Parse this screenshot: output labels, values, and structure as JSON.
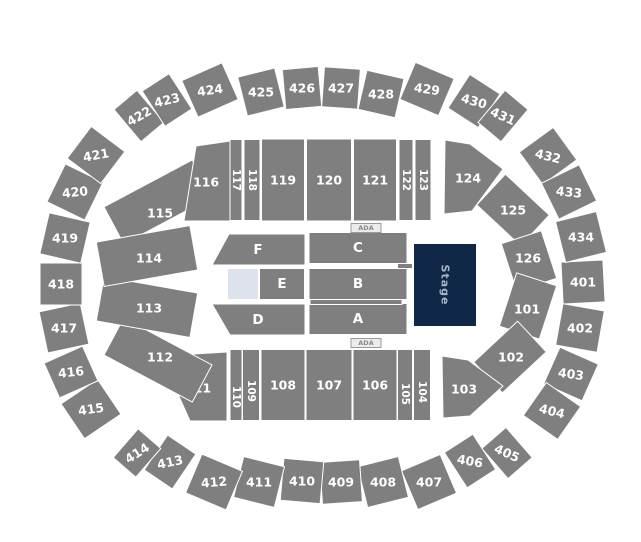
{
  "colors": {
    "section": "#7f7f7f",
    "sectionStroke": "#ffffff",
    "label": "#ffffff",
    "stage": "#0f2848",
    "stage_text": "#a9b4c6",
    "open": "#dce3ec",
    "ada_bg": "#ececec",
    "ada_border": "#9a9a9a",
    "ada_text": "#8a8a8a",
    "background": "#ffffff"
  },
  "map": {
    "width": 641,
    "height": 542,
    "sections": [
      {
        "label": "401",
        "cx": 583,
        "cy": 282,
        "w": 42,
        "h": 42,
        "rot": 87
      },
      {
        "label": "402",
        "cx": 580,
        "cy": 328,
        "w": 42,
        "h": 42,
        "rot": -80
      },
      {
        "label": "403",
        "cx": 571,
        "cy": 374,
        "w": 40,
        "h": 42,
        "rot": -66,
        "lrot": 8
      },
      {
        "label": "404",
        "cx": 552,
        "cy": 411,
        "w": 40,
        "h": 42,
        "rot": -55,
        "lrot": 14
      },
      {
        "label": "405",
        "cx": 507,
        "cy": 453,
        "w": 32,
        "h": 40,
        "rot": -41,
        "lrot": 24
      },
      {
        "label": "406",
        "cx": 470,
        "cy": 461,
        "w": 34,
        "h": 42,
        "rot": -33,
        "lrot": 10
      },
      {
        "label": "407",
        "cx": 429,
        "cy": 482,
        "w": 42,
        "h": 42,
        "rot": -23
      },
      {
        "label": "408",
        "cx": 383,
        "cy": 482,
        "w": 42,
        "h": 42,
        "rot": -14
      },
      {
        "label": "409",
        "cx": 341,
        "cy": 482,
        "w": 40,
        "h": 42,
        "rot": -4
      },
      {
        "label": "410",
        "cx": 302,
        "cy": 481,
        "w": 40,
        "h": 42,
        "rot": 5
      },
      {
        "label": "411",
        "cx": 259,
        "cy": 482,
        "w": 42,
        "h": 42,
        "rot": 14
      },
      {
        "label": "412",
        "cx": 214,
        "cy": 482,
        "w": 44,
        "h": 42,
        "rot": 23,
        "lrot": -5
      },
      {
        "label": "413",
        "cx": 170,
        "cy": 462,
        "w": 34,
        "h": 42,
        "rot": 34,
        "lrot": -12
      },
      {
        "label": "414",
        "cx": 137,
        "cy": 453,
        "w": 30,
        "h": 38,
        "rot": 41,
        "lrot": -33
      },
      {
        "label": "415",
        "cx": 91,
        "cy": 409,
        "w": 42,
        "h": 44,
        "rot": 56,
        "lrot": -8
      },
      {
        "label": "416",
        "cx": 71,
        "cy": 372,
        "w": 38,
        "h": 42,
        "rot": 66,
        "lrot": -6
      },
      {
        "label": "417",
        "cx": 64,
        "cy": 328,
        "w": 42,
        "h": 42,
        "rot": 78
      },
      {
        "label": "418",
        "cx": 61,
        "cy": 284,
        "w": 42,
        "h": 42,
        "rot": 90
      },
      {
        "label": "419",
        "cx": 65,
        "cy": 238,
        "w": 42,
        "h": 42,
        "rot": -77
      },
      {
        "label": "420",
        "cx": 75,
        "cy": 192,
        "w": 42,
        "h": 42,
        "rot": -64,
        "lrot": -6
      },
      {
        "label": "421",
        "cx": 96,
        "cy": 155,
        "w": 40,
        "h": 42,
        "rot": -53,
        "lrot": -10
      },
      {
        "label": "422",
        "cx": 139,
        "cy": 116,
        "w": 30,
        "h": 42,
        "rot": -40,
        "lrot": -30
      },
      {
        "label": "423",
        "cx": 167,
        "cy": 100,
        "w": 32,
        "h": 42,
        "rot": -33,
        "lrot": -14
      },
      {
        "label": "424",
        "cx": 210,
        "cy": 90,
        "w": 44,
        "h": 40,
        "rot": -24,
        "lrot": -8
      },
      {
        "label": "425",
        "cx": 261,
        "cy": 92,
        "w": 38,
        "h": 40,
        "rot": -14
      },
      {
        "label": "426",
        "cx": 302,
        "cy": 88,
        "w": 36,
        "h": 40,
        "rot": -5
      },
      {
        "label": "427",
        "cx": 341,
        "cy": 88,
        "w": 36,
        "h": 40,
        "rot": 4
      },
      {
        "label": "428",
        "cx": 381,
        "cy": 94,
        "w": 38,
        "h": 40,
        "rot": 13
      },
      {
        "label": "429",
        "cx": 427,
        "cy": 89,
        "w": 42,
        "h": 40,
        "rot": 23,
        "lrot": 8
      },
      {
        "label": "430",
        "cx": 474,
        "cy": 101,
        "w": 36,
        "h": 40,
        "rot": 33,
        "lrot": 16
      },
      {
        "label": "431",
        "cx": 503,
        "cy": 116,
        "w": 30,
        "h": 42,
        "rot": 40,
        "lrot": 24
      },
      {
        "label": "432",
        "cx": 548,
        "cy": 156,
        "w": 40,
        "h": 42,
        "rot": 54,
        "lrot": 14
      },
      {
        "label": "433",
        "cx": 569,
        "cy": 192,
        "w": 40,
        "h": 42,
        "rot": 64,
        "lrot": 6
      },
      {
        "label": "434",
        "cx": 581,
        "cy": 237,
        "w": 42,
        "h": 42,
        "rot": 76
      },
      {
        "label": "115",
        "cx": 158,
        "cy": 202,
        "w": 100,
        "h": 42,
        "rot": -28,
        "lx": 160,
        "ly": 213
      },
      {
        "label": "116",
        "kind": "poly",
        "points": [
          [
            196,
            146
          ],
          [
            230,
            141
          ],
          [
            230,
            221
          ],
          [
            184,
            221
          ]
        ],
        "lx": 206,
        "ly": 182
      },
      {
        "label": "117",
        "cx": 236,
        "cy": 180,
        "w": 12,
        "h": 81,
        "lrot": 90,
        "fs": 10.5
      },
      {
        "label": "118",
        "cx": 252,
        "cy": 180,
        "w": 16,
        "h": 81,
        "lrot": 90,
        "fs": 10.5
      },
      {
        "label": "119",
        "cx": 283,
        "cy": 180,
        "w": 43,
        "h": 82
      },
      {
        "label": "120",
        "cx": 329,
        "cy": 180,
        "w": 45,
        "h": 82
      },
      {
        "label": "121",
        "cx": 375,
        "cy": 180,
        "w": 43,
        "h": 82
      },
      {
        "label": "122",
        "cx": 406,
        "cy": 180,
        "w": 14,
        "h": 81,
        "lrot": 90,
        "fs": 10.5
      },
      {
        "label": "123",
        "cx": 423,
        "cy": 180,
        "w": 16,
        "h": 81,
        "lrot": 90,
        "fs": 10.5
      },
      {
        "label": "124",
        "kind": "poly",
        "points": [
          [
            445,
            140
          ],
          [
            444,
            214
          ],
          [
            472,
            211
          ],
          [
            503,
            169
          ],
          [
            470,
            144
          ]
        ],
        "lx": 468,
        "ly": 178
      },
      {
        "label": "125",
        "cx": 513,
        "cy": 210,
        "w": 60,
        "h": 42,
        "rot": 43
      },
      {
        "label": "126",
        "cx": 529,
        "cy": 261,
        "w": 50,
        "h": 42,
        "rot": 72,
        "lx": 528,
        "ly": 258
      },
      {
        "label": "101",
        "cx": 528,
        "cy": 306,
        "w": 56,
        "h": 42,
        "rot": -72,
        "lx": 527,
        "ly": 309
      },
      {
        "label": "102",
        "cx": 510,
        "cy": 357,
        "w": 60,
        "h": 42,
        "rot": -43,
        "lx": 511,
        "ly": 357
      },
      {
        "label": "103",
        "kind": "poly",
        "points": [
          [
            442,
            356
          ],
          [
            468,
            360
          ],
          [
            503,
            386
          ],
          [
            470,
            416
          ],
          [
            443,
            418
          ]
        ],
        "lx": 464,
        "ly": 389
      },
      {
        "label": "104",
        "cx": 422,
        "cy": 385,
        "w": 17,
        "h": 71,
        "lrot": 90,
        "fs": 10.5,
        "ly": 392
      },
      {
        "label": "105",
        "cx": 405,
        "cy": 385,
        "w": 15,
        "h": 71,
        "lrot": 90,
        "fs": 10.5,
        "ly": 394
      },
      {
        "label": "106",
        "cx": 375,
        "cy": 385,
        "w": 44,
        "h": 71
      },
      {
        "label": "107",
        "cx": 329,
        "cy": 385,
        "w": 46,
        "h": 71
      },
      {
        "label": "108",
        "cx": 283,
        "cy": 385,
        "w": 44,
        "h": 71
      },
      {
        "label": "109",
        "cx": 251,
        "cy": 385,
        "w": 17,
        "h": 71,
        "lrot": 90,
        "fs": 10.5,
        "ly": 391
      },
      {
        "label": "110",
        "cx": 236,
        "cy": 385,
        "w": 12,
        "h": 71,
        "lrot": 90,
        "fs": 10.5,
        "ly": 397
      },
      {
        "label": "111",
        "kind": "poly",
        "points": [
          [
            161,
            356
          ],
          [
            227,
            352
          ],
          [
            227,
            421
          ],
          [
            190,
            421
          ]
        ],
        "lx": 198,
        "ly": 388
      },
      {
        "label": "112",
        "cx": 158,
        "cy": 360,
        "w": 100,
        "h": 42,
        "rot": 28,
        "lx": 160,
        "ly": 357
      },
      {
        "label": "113",
        "cx": 147,
        "cy": 307,
        "w": 95,
        "h": 45,
        "rot": 10,
        "lx": 149,
        "ly": 308
      },
      {
        "label": "114",
        "cx": 147,
        "cy": 256,
        "w": 95,
        "h": 45,
        "rot": -10,
        "lx": 149,
        "ly": 258
      },
      {
        "label": "F",
        "kind": "poly",
        "points": [
          [
            229,
            234
          ],
          [
            305,
            234
          ],
          [
            305,
            265
          ],
          [
            212,
            265
          ]
        ],
        "lx": 258,
        "ly": 250,
        "fs": 13.5,
        "name": "floor-F"
      },
      {
        "label": "C",
        "cx": 358,
        "cy": 248,
        "w": 98,
        "h": 31,
        "fs": 13.5,
        "name": "floor-C"
      },
      {
        "label": "E",
        "cx": 282,
        "cy": 284,
        "w": 45,
        "h": 31,
        "fs": 13.5,
        "name": "floor-E"
      },
      {
        "label": "B",
        "cx": 358,
        "cy": 284,
        "w": 98,
        "h": 31,
        "fs": 13.5,
        "name": "floor-B"
      },
      {
        "label": "D",
        "kind": "poly",
        "points": [
          [
            212,
            304
          ],
          [
            305,
            304
          ],
          [
            305,
            335
          ],
          [
            230,
            335
          ]
        ],
        "lx": 258,
        "ly": 320,
        "fs": 13.5,
        "name": "floor-D"
      },
      {
        "label": "A",
        "cx": 358,
        "cy": 319,
        "w": 98,
        "h": 31,
        "fs": 13.5,
        "name": "floor-A"
      },
      {
        "label": "",
        "cx": 405,
        "cy": 266,
        "w": 15,
        "h": 5,
        "name": "floor-walkway-right",
        "interactable": false
      },
      {
        "label": "",
        "cx": 356,
        "cy": 302,
        "w": 92,
        "h": 5,
        "name": "floor-walkway-center",
        "interactable": false
      },
      {
        "label": "",
        "cx": 243,
        "cy": 284,
        "w": 31,
        "h": 31,
        "fill": "open",
        "name": "open-floor-area",
        "interactable": false
      },
      {
        "label": "Stage",
        "cx": 445,
        "cy": 285,
        "w": 63,
        "h": 83,
        "fill": "stage",
        "labelColor": "stage_text",
        "fs": 11,
        "lrot": 90,
        "ls": 1,
        "name": "stage",
        "interactable": false
      },
      {
        "label": "ADA",
        "cx": 366,
        "cy": 228,
        "w": 30,
        "h": 9,
        "fill": "ada_bg",
        "strokeColor": "ada_border",
        "labelColor": "ada_text",
        "fs": 6.5,
        "name": "ada-indicator-top",
        "interactable": false
      },
      {
        "label": "ADA",
        "cx": 366,
        "cy": 343,
        "w": 30,
        "h": 9,
        "fill": "ada_bg",
        "strokeColor": "ada_border",
        "labelColor": "ada_text",
        "fs": 6.5,
        "name": "ada-indicator-bottom",
        "interactable": false
      }
    ]
  }
}
